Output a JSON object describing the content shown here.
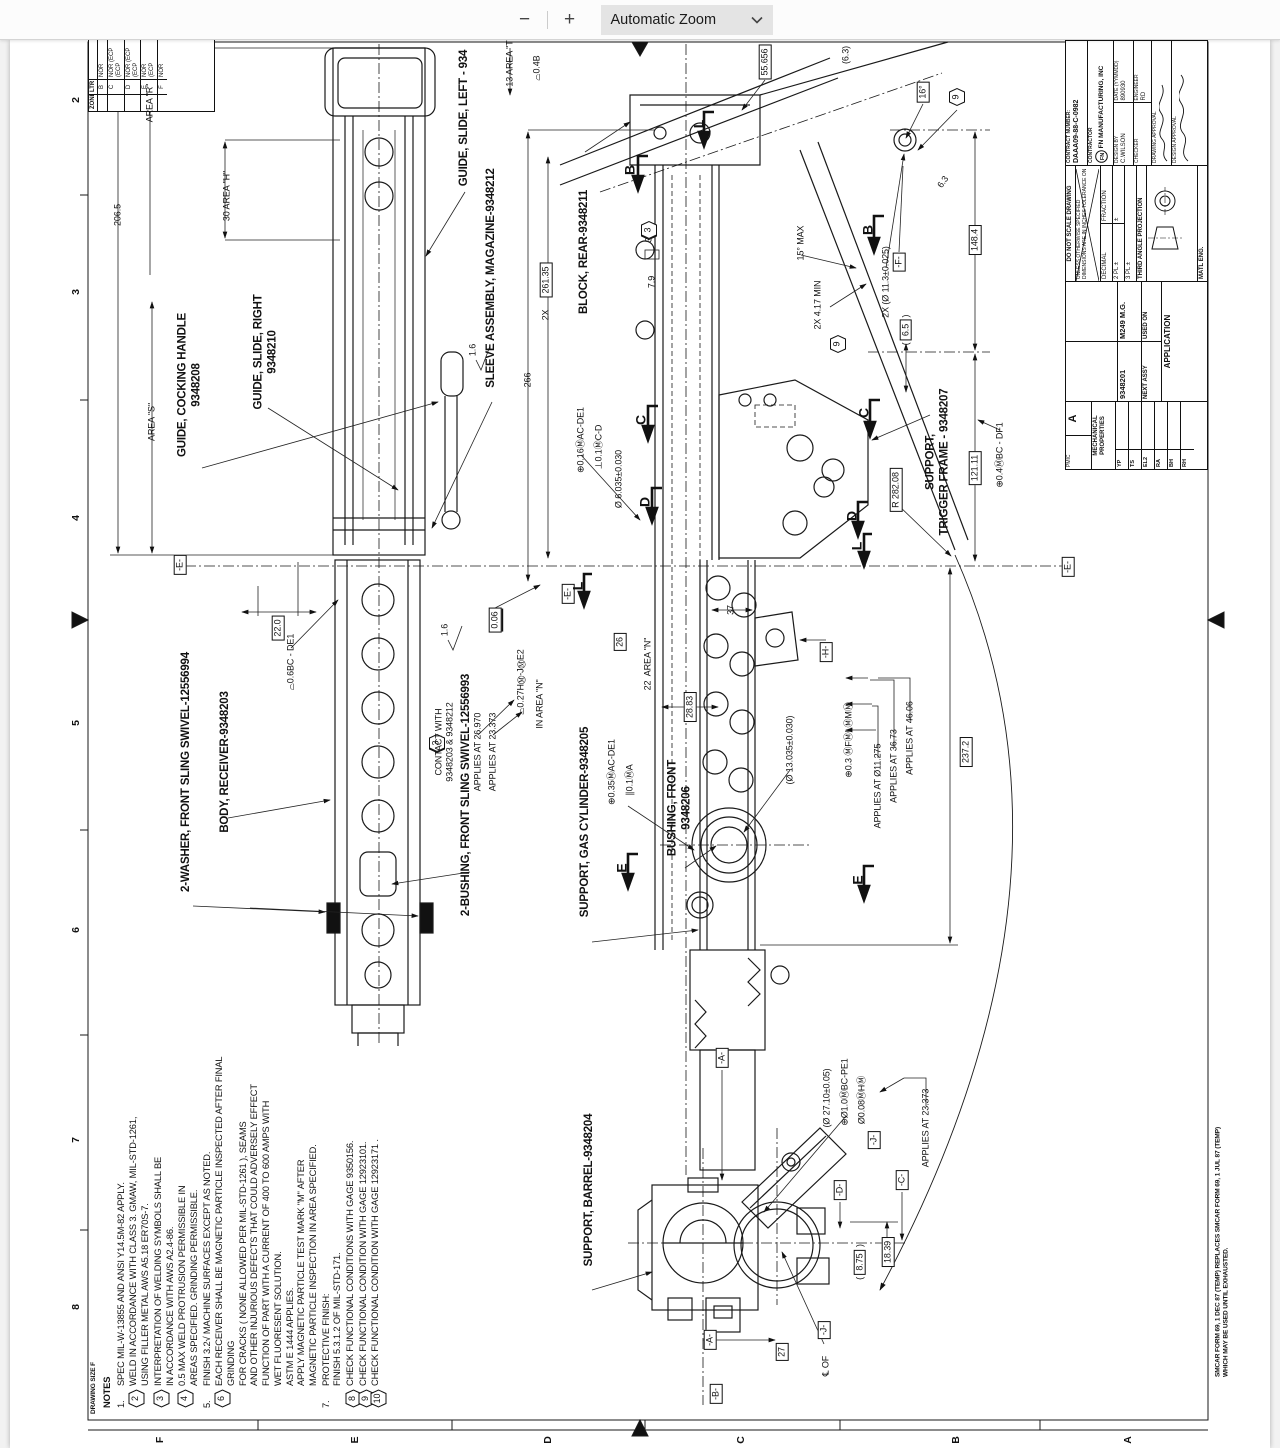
{
  "toolbar": {
    "zoom_out": "−",
    "zoom_in": "+",
    "zoom_label": "Automatic Zoom"
  },
  "page": {
    "zones_left": [
      "2",
      "3",
      "4",
      "5",
      "6",
      "7",
      "8"
    ],
    "zones_bottom": [
      "F",
      "E",
      "D",
      "C",
      "B",
      "A"
    ],
    "drawing_size_note": "DRAWING SIZE F",
    "form_note": "SMCAR FORM 69, 1 DEC 87 (TEMP) REPLACES SMCAR FORM 69, 1 JUL 87 (TEMP)\nWHICH MAY BE USED UNTIL EXHAUSTED."
  },
  "rev_table": {
    "zone_label": "ZONE",
    "ltr_label": "LTR",
    "rows": [
      {
        "ltr": "B",
        "desc": "NOR"
      },
      {
        "ltr": "C",
        "desc": "NOR (ECP\n(ECP"
      },
      {
        "ltr": "D",
        "desc": "NOR (ECP\n(ECP"
      },
      {
        "ltr": "E",
        "desc": "NOR\n(ECP"
      },
      {
        "ltr": "F",
        "desc": "NOR"
      }
    ]
  },
  "title_block": {
    "pmic_label": "PMIC",
    "pmic": "A",
    "mech_label": "MECHANICAL\nPROPERTIES",
    "mech_rows": [
      "YP",
      "TS",
      "EL2",
      "RA",
      "BH",
      "RH"
    ],
    "next_assy_value": "9348201",
    "next_assy_label": "NEXT ASSY",
    "used_on_value": "M249 M.G.",
    "used_on_label": "USED ON",
    "application_label": "APPLICATION",
    "do_not_scale": "DO NOT SCALE DRAWING",
    "unless": "UNLESS OTHERWISE SPECIFIED DIMENSIONS ARE IN INCHES TOLERANCE ON",
    "decimal": "DECIMAL",
    "fraction": "FRACTION",
    "pl2": "2 PL ±",
    "pl3": "3 PL ±",
    "pm": "±",
    "third_angle": "THIRD ANGLE PROJECTION",
    "matl_eng": "MATL ENG.",
    "contract_label": "CONTRACT NUMBER:",
    "contract_value": "DAAA09-88-C-0982",
    "contractor_label": "CONTRACTOR",
    "contractor_value": "FN MANUFACTURING, INC",
    "logo_text": "FN",
    "design_by_label": "DESIGN BY",
    "design_by": "C.WILSON",
    "date_label": "DATE (YYMMDD)",
    "date": "890930",
    "checker_label": "CHECKER",
    "engineer_label": "ENGINEER",
    "engineer": "RD",
    "drawing_approval_label": "DRAWING APPROVAL",
    "design_approval_label": "DESIGN APPROVAL"
  },
  "notes": {
    "title": "NOTES",
    "items": [
      {
        "flag": "1.",
        "hex": false,
        "text": "SPEC MIL-W-13855 AND ANSI Y14.5M-82 APPLY."
      },
      {
        "flag": "2",
        "hex": true,
        "text": "WELD IN ACCORDANCE WITH CLASS 3. GMAW, MIL-STD-1261,\nUSING FILLER METAL AWS A5.18 ER70S-7."
      },
      {
        "flag": "3",
        "hex": true,
        "text": "INTERPRETATION OF WELDING SYMBOLS SHALL BE\nIN ACCORDANCE WITH AWS A2.4-86."
      },
      {
        "flag": "4",
        "hex": true,
        "text": "0.5 MAX WELD PROTRUSION PERMISSIBLE IN\nAREAS SPECIFIED. GRINDING PERMISSIBLE."
      },
      {
        "flag": "5.",
        "hex": false,
        "text": "FINISH 3.2√ MACHINE SURFACES EXCEPT AS NOTED."
      },
      {
        "flag": "6",
        "hex": true,
        "text": "EACH RECEIVER SHALL BE MAGNETIC PARTICLE INSPECTED AFTER FINAL GRINDING\nFOR CRACKS ( NONE ALLOWED PER MIL-STD-1261 ), SEAMS\nAND OTHER INJURIOUS DEFECTS THAT COULD ADVERSELY EFFECT\nFUNCTION OF PART WITH A CURRENT OF 400 TO 600 AMPS WITH\nWET FLUORESENT SOLUTION.\nASTM E 1444 APPLIES.\nAPPLY MAGNETIC PARTICLE TEST MARK \"M\" AFTER\nMAGNETIC PARTICLE INSPECTION IN AREA SPECIFIED."
      },
      {
        "flag": "7.",
        "hex": false,
        "text": "PROTECTIVE FINISH:\nFINISH 5.3.1.2 OF MIL-STD-171."
      },
      {
        "flag": "8",
        "hex": true,
        "text": "CHECK FUNCTIONAL CONDITIONS WITH GAGE 9350156."
      },
      {
        "flag": "9",
        "hex": true,
        "text": "CHECK FUNCTIONAL CONDITION WITH GAGE 12923101."
      },
      {
        "flag": "10",
        "hex": true,
        "text": "CHECK FUNCTIONAL CONDITION WITH GAGE 12923171 ."
      }
    ]
  },
  "annotations": [
    {
      "n": "part-label-guide-slide-left",
      "x": 465,
      "y": 118,
      "t": "label",
      "s": "GUIDE, SLIDE, LEFT - 934"
    },
    {
      "n": "part-label-guide-cocking-handle",
      "x": 190,
      "y": 385,
      "t": "label",
      "s": "GUIDE, COCKING HANDLE\n9348208"
    },
    {
      "n": "part-label-guide-slide-right",
      "x": 266,
      "y": 352,
      "t": "label",
      "s": "GUIDE, SLIDE, RIGHT\n9348210"
    },
    {
      "n": "part-label-sleeve-assembly",
      "x": 492,
      "y": 278,
      "t": "label",
      "s": "SLEEVE ASSEMBLY, MAGAZINE-9348212"
    },
    {
      "n": "part-label-block-rear",
      "x": 585,
      "y": 252,
      "t": "label",
      "s": "BLOCK, REAR-9348211"
    },
    {
      "n": "part-label-body-receiver",
      "x": 226,
      "y": 762,
      "t": "label",
      "s": "BODY, RECEIVER-9348203"
    },
    {
      "n": "part-label-washer-front-sling",
      "x": 187,
      "y": 772,
      "t": "label",
      "s": "2-WASHER, FRONT SLING SWIVEL-12556994"
    },
    {
      "n": "part-label-support-gas-cyl",
      "x": 586,
      "y": 822,
      "t": "label",
      "s": "SUPPORT, GAS CYLINDER-9348205"
    },
    {
      "n": "part-label-bushing-front",
      "x": 680,
      "y": 808,
      "t": "label",
      "s": "BUSHING, FRONT\n9348206"
    },
    {
      "n": "part-label-support-trigger",
      "x": 938,
      "y": 462,
      "t": "label",
      "s": "SUPPORT,\nTRIGGER FRAME - 9348207"
    },
    {
      "n": "part-label-bushing-sling",
      "x": 467,
      "y": 795,
      "t": "label",
      "s": "2-BUSHING, FRONT SLING SWIVEL-12556993"
    },
    {
      "n": "part-label-support-barrel",
      "x": 590,
      "y": 1190,
      "t": "label",
      "s": "SUPPORT, BARREL-9348204"
    },
    {
      "n": "dim-206-5",
      "x": 118,
      "y": 215,
      "t": "dim",
      "s": "206.5"
    },
    {
      "n": "dim-area-r",
      "x": 150,
      "y": 103,
      "t": "dim",
      "s": "AREA \"R\""
    },
    {
      "n": "dim-area-s",
      "x": 152,
      "y": 422,
      "t": "dim",
      "s": "AREA \"S\""
    },
    {
      "n": "dim-30-area-h",
      "x": 227,
      "y": 196,
      "t": "dim",
      "s": "30 AREA \"H\""
    },
    {
      "n": "dim-13-area-t",
      "x": 510,
      "y": 62,
      "t": "dim",
      "s": "13 AREA \"T\""
    },
    {
      "n": "fcf-04-b",
      "x": 537,
      "y": 68,
      "t": "fcf",
      "c": [
        "⌓",
        "0.4",
        "B"
      ]
    },
    {
      "n": "dim-55-656",
      "x": 765,
      "y": 62,
      "t": "box",
      "s": "55.656"
    },
    {
      "n": "dim-6-3-ref",
      "x": 846,
      "y": 55,
      "t": "dim",
      "s": "(6.3)"
    },
    {
      "n": "dim-16-deg",
      "x": 923,
      "y": 92,
      "t": "box",
      "s": "16°"
    },
    {
      "n": "flag-note-9a",
      "x": 957,
      "y": 97,
      "t": "hex",
      "s": "9"
    },
    {
      "n": "dim-6-3",
      "x": 943,
      "y": 182,
      "t": "dim",
      "s": "6.3",
      "r": -55
    },
    {
      "n": "dim-2x",
      "x": 546,
      "y": 315,
      "t": "dim",
      "s": "2X"
    },
    {
      "n": "dim-261-35",
      "x": 546,
      "y": 280,
      "t": "box",
      "s": "261.35"
    },
    {
      "n": "dim-266",
      "x": 528,
      "y": 380,
      "t": "dim",
      "s": "266"
    },
    {
      "n": "dim-7-9",
      "x": 652,
      "y": 282,
      "t": "dim",
      "s": "7.9"
    },
    {
      "n": "dim-3x",
      "x": 649,
      "y": 237,
      "t": "dim",
      "s": "3X"
    },
    {
      "n": "flag-note-2a",
      "x": 649,
      "y": 214,
      "t": "hex",
      "s": "2"
    },
    {
      "n": "flag-note-3a",
      "x": 649,
      "y": 196,
      "t": "hex",
      "s": "3"
    },
    {
      "n": "dim-15-max",
      "x": 801,
      "y": 243,
      "t": "dim",
      "s": "15° MAX"
    },
    {
      "n": "dim-4-17-min",
      "x": 818,
      "y": 305,
      "t": "dim",
      "s": "2X 4.17 MIN"
    },
    {
      "n": "flag-note-9b",
      "x": 838,
      "y": 293,
      "t": "hex",
      "s": "9"
    },
    {
      "n": "dim-11-3",
      "x": 886,
      "y": 282,
      "t": "dim",
      "s": "2X (Ø 11.3±0.025)"
    },
    {
      "n": "datum-f",
      "x": 899,
      "y": 262,
      "t": "datum",
      "s": "-F-"
    },
    {
      "n": "dim-6-5",
      "x": 906,
      "y": 330,
      "t": "pbox",
      "s": "6.5"
    },
    {
      "n": "dim-148-4",
      "x": 975,
      "y": 240,
      "t": "box",
      "s": "148.4"
    },
    {
      "n": "dim-121-11",
      "x": 975,
      "y": 468,
      "t": "box",
      "s": "121.11"
    },
    {
      "n": "dim-r-282-08",
      "x": 896,
      "y": 490,
      "t": "box",
      "s": "R 282.08"
    },
    {
      "n": "fcf-pos-04",
      "x": 1000,
      "y": 455,
      "t": "fcf",
      "c": [
        "⊕",
        "0.4Ⓜ",
        "B",
        "C - D",
        "F1"
      ]
    },
    {
      "n": "datum-e-right",
      "x": 1068,
      "y": 567,
      "t": "datum",
      "s": "-E-"
    },
    {
      "n": "datum-e-left",
      "x": 180,
      "y": 565,
      "t": "datum",
      "s": "-E-"
    },
    {
      "n": "datum-e-mid",
      "x": 568,
      "y": 594,
      "t": "datum",
      "s": "-E-"
    },
    {
      "n": "dim-22-0",
      "x": 278,
      "y": 628,
      "t": "box",
      "s": "22.0"
    },
    {
      "n": "fcf-prof-06",
      "x": 291,
      "y": 662,
      "t": "fcf",
      "c": [
        "⌓",
        "0.6",
        "B",
        "C - D",
        "E1"
      ]
    },
    {
      "n": "dim-0-06",
      "x": 495,
      "y": 620,
      "t": "ubox",
      "s": "0.06"
    },
    {
      "n": "finish-1-6-a",
      "x": 445,
      "y": 630,
      "t": "dim",
      "s": "1.6"
    },
    {
      "n": "finish-1-6-b",
      "x": 473,
      "y": 350,
      "t": "dim",
      "s": "1.6"
    },
    {
      "n": "flag-note-2b",
      "x": 437,
      "y": 676,
      "t": "hex",
      "s": "2"
    },
    {
      "n": "flag-note-3b",
      "x": 437,
      "y": 658,
      "t": "hex",
      "s": "3"
    },
    {
      "n": "note-contact",
      "x": 444,
      "y": 742,
      "t": "text",
      "s": "CONTACT WITH\n9348203 & 9348212"
    },
    {
      "n": "note-applies-26970",
      "x": 478,
      "y": 752,
      "t": "text",
      "s": "APPLIES AT 26.970"
    },
    {
      "n": "note-applies-23373a",
      "x": 493,
      "y": 752,
      "t": "text",
      "s": "APPLIES AT 23.373"
    },
    {
      "n": "fcf-prof-027",
      "x": 521,
      "y": 682,
      "t": "fcf",
      "c": [
        "⌓",
        "0.27",
        "HⓂ-JⓂ",
        "E2"
      ]
    },
    {
      "n": "note-in-area-n",
      "x": 540,
      "y": 704,
      "t": "text",
      "s": "IN AREA \"N\""
    },
    {
      "n": "dim-6-035",
      "x": 619,
      "y": 479,
      "t": "dim",
      "s": "Ø 6.035±0.030"
    },
    {
      "n": "fcf-pos-016",
      "x": 581,
      "y": 440,
      "t": "fcf",
      "c": [
        "⊕",
        "0.16Ⓜ",
        "A",
        "C-D",
        "E1"
      ]
    },
    {
      "n": "fcf-perp-01",
      "x": 599,
      "y": 447,
      "t": "fcf",
      "c": [
        "⊥",
        "0.1Ⓜ",
        "C-D"
      ]
    },
    {
      "n": "dim-26",
      "x": 620,
      "y": 642,
      "t": "box",
      "s": "26"
    },
    {
      "n": "dim-22-area-n",
      "x": 648,
      "y": 664,
      "t": "dim",
      "s": "22  AREA \"N\""
    },
    {
      "n": "dim-37",
      "x": 731,
      "y": 610,
      "t": "dim",
      "s": "37"
    },
    {
      "n": "dim-28-83",
      "x": 690,
      "y": 707,
      "t": "box",
      "s": "28.83"
    },
    {
      "n": "datum-h",
      "x": 826,
      "y": 652,
      "t": "datum",
      "s": "-H-"
    },
    {
      "n": "fcf-pos-035",
      "x": 612,
      "y": 772,
      "t": "fcf",
      "c": [
        "⊕",
        "0.35Ⓜ",
        "A",
        "C-D",
        "E1"
      ]
    },
    {
      "n": "fcf-par-01",
      "x": 630,
      "y": 780,
      "t": "fcf",
      "c": [
        "∥",
        "0.1Ⓜ",
        "A"
      ]
    },
    {
      "n": "dim-13-035",
      "x": 790,
      "y": 750,
      "t": "dim",
      "s": "(Ø 13.035±0.030)"
    },
    {
      "n": "fcf-pos-03",
      "x": 849,
      "y": 740,
      "t": "fcf",
      "c": [
        "⊕",
        "0.3 Ⓜ",
        "FⓂ",
        "LⓂ",
        "MⓂ"
      ]
    },
    {
      "n": "note-applies-11275",
      "x": 878,
      "y": 786,
      "t": "text",
      "s": "APPLIES AT Ø11.275"
    },
    {
      "n": "note-applies-3673",
      "x": 894,
      "y": 766,
      "t": "text",
      "s": "APPLIES AT 36.73"
    },
    {
      "n": "note-applies-4606",
      "x": 910,
      "y": 738,
      "t": "text",
      "s": "APPLIES AT 46.06"
    },
    {
      "n": "dim-237-2",
      "x": 966,
      "y": 752,
      "t": "box",
      "s": "237.2"
    },
    {
      "n": "section-b-left",
      "x": 630,
      "y": 170,
      "t": "sec",
      "s": "B"
    },
    {
      "n": "section-b-right",
      "x": 868,
      "y": 230,
      "t": "sec",
      "s": "B"
    },
    {
      "n": "section-c-left",
      "x": 641,
      "y": 420,
      "t": "sec",
      "s": "C"
    },
    {
      "n": "section-c-right",
      "x": 864,
      "y": 413,
      "t": "sec",
      "s": "C"
    },
    {
      "n": "section-d-left",
      "x": 645,
      "y": 502,
      "t": "sec",
      "s": "D"
    },
    {
      "n": "section-d-right",
      "x": 852,
      "y": 516,
      "t": "sec",
      "s": "D"
    },
    {
      "n": "section-e-left",
      "x": 622,
      "y": 868,
      "t": "sec",
      "s": "E"
    },
    {
      "n": "section-e-right",
      "x": 858,
      "y": 880,
      "t": "sec",
      "s": "E"
    },
    {
      "n": "section-l-top",
      "x": 699,
      "y": 124,
      "t": "sec",
      "s": "L"
    },
    {
      "n": "section-l-mid",
      "x": 578,
      "y": 586,
      "t": "sec",
      "s": "L"
    },
    {
      "n": "section-l-right",
      "x": 857,
      "y": 546,
      "t": "sec",
      "s": "L"
    },
    {
      "n": "datum-a-top",
      "x": 722,
      "y": 1058,
      "t": "datum",
      "s": "-A-"
    },
    {
      "n": "dim-27-10",
      "x": 827,
      "y": 1098,
      "t": "dim",
      "s": "(Ø 27.10±0.05)"
    },
    {
      "n": "fcf-pos-10",
      "x": 845,
      "y": 1092,
      "t": "fcf",
      "c": [
        "⊕",
        "Ø1.0Ⓜ",
        "B",
        "C-P",
        "E1"
      ]
    },
    {
      "n": "fcf-pos-008",
      "x": 862,
      "y": 1100,
      "t": "fcf",
      "c": [
        "Ø0.08Ⓜ",
        "HⓂ"
      ]
    },
    {
      "n": "datum-j-top",
      "x": 874,
      "y": 1140,
      "t": "datum",
      "s": "-J-"
    },
    {
      "n": "note-applies-23373b",
      "x": 926,
      "y": 1128,
      "t": "text",
      "s": "APPLIES AT 23.373"
    },
    {
      "n": "datum-d",
      "x": 840,
      "y": 1190,
      "t": "datum",
      "s": "-D-"
    },
    {
      "n": "datum-c",
      "x": 902,
      "y": 1180,
      "t": "datum",
      "s": "-C-"
    },
    {
      "n": "dim-8-75",
      "x": 860,
      "y": 1262,
      "t": "pbox",
      "s": "8.75"
    },
    {
      "n": "dim-18-39",
      "x": 888,
      "y": 1252,
      "t": "box",
      "s": "18.39"
    },
    {
      "n": "datum-a-bottom",
      "x": 710,
      "y": 1340,
      "t": "datum",
      "s": "-A-"
    },
    {
      "n": "datum-b",
      "x": 716,
      "y": 1394,
      "t": "datum",
      "s": "-B-"
    },
    {
      "n": "dim-27",
      "x": 782,
      "y": 1352,
      "t": "box",
      "s": "27"
    },
    {
      "n": "datum-j-bottom",
      "x": 824,
      "y": 1330,
      "t": "datum",
      "s": "-J-"
    },
    {
      "n": "note-cl-of-j",
      "x": 826,
      "y": 1366,
      "t": "text",
      "s": "℄ OF"
    }
  ]
}
